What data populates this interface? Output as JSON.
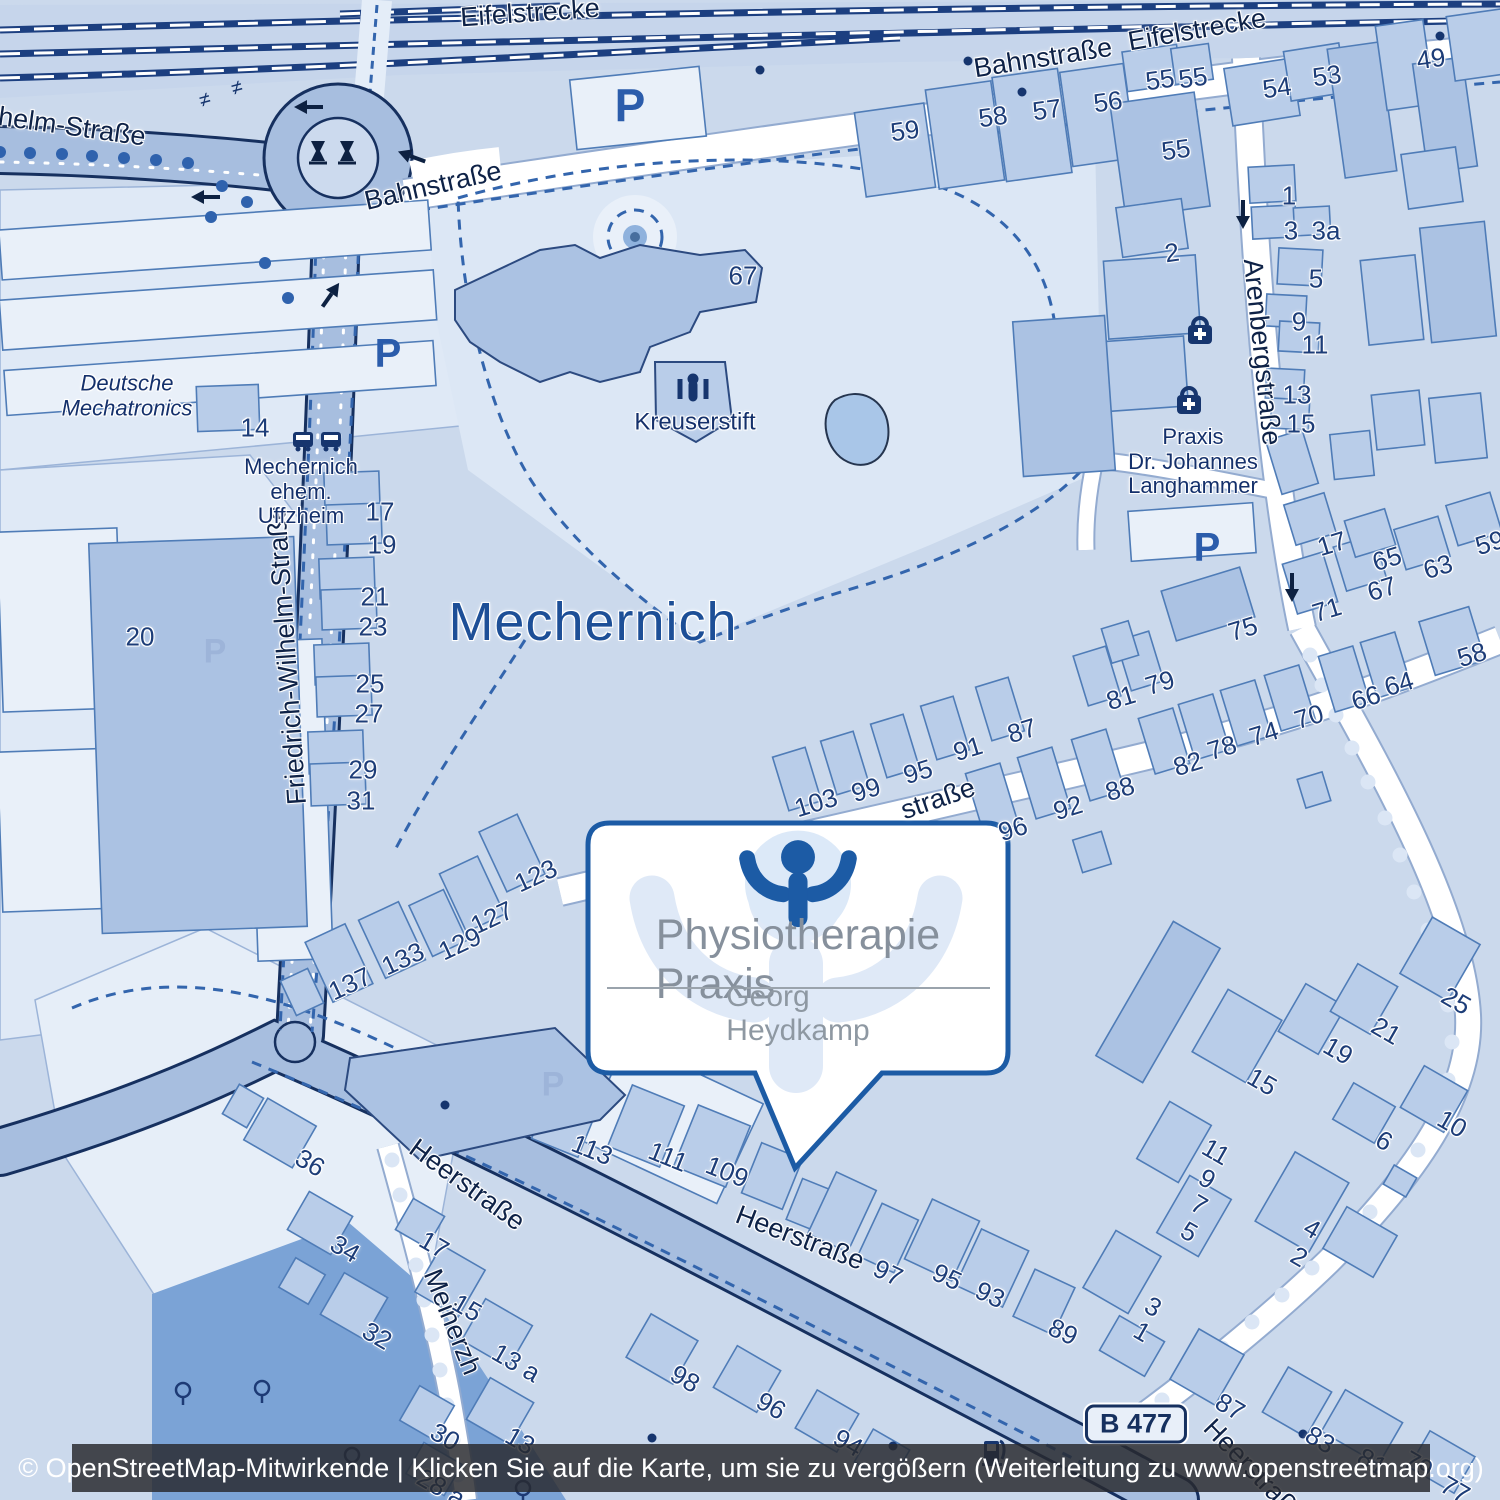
{
  "attribution": {
    "text": "© OpenStreetMap-Mitwirkende | Klicken Sie auf die Karte, um sie zu vergößern (Weiterleitung zu www.openstreetmap.org)"
  },
  "callout": {
    "title": "Physiotherapie Praxis",
    "subtitle": "Georg Heydkamp",
    "logo": "raised-arms-person-icon"
  },
  "route_badge": {
    "text": "B 477",
    "x": 1136,
    "y": 1424
  },
  "city_label": {
    "text": "Mechernich",
    "x": 593,
    "y": 622
  },
  "street_labels": [
    {
      "t": "Eifelstrecke",
      "x": 530,
      "y": 13,
      "r": -4
    },
    {
      "t": "Eifelstrecke",
      "x": 1197,
      "y": 30,
      "r": -10
    },
    {
      "t": "Bahnstraße",
      "x": 1043,
      "y": 58,
      "r": -9
    },
    {
      "t": "Bahnstraße",
      "x": 433,
      "y": 186,
      "r": -13
    },
    {
      "t": "ilhelm-Straße",
      "x": 66,
      "y": 126,
      "r": 8
    },
    {
      "t": "Friedrich-Wilhelm-Straße",
      "x": 287,
      "y": 655,
      "r": -94
    },
    {
      "t": "Arenbergstraße",
      "x": 1262,
      "y": 352,
      "r": 84
    },
    {
      "t": "Heerstraße",
      "x": 467,
      "y": 1185,
      "r": 36
    },
    {
      "t": "Heerstraße",
      "x": 800,
      "y": 1238,
      "r": 21
    },
    {
      "t": "Heerstraße",
      "x": 1255,
      "y": 1472,
      "r": 46
    },
    {
      "t": "Meinerzh",
      "x": 452,
      "y": 1322,
      "r": 68
    },
    {
      "t": "straße",
      "x": 938,
      "y": 799,
      "r": -19
    }
  ],
  "poi_labels": [
    {
      "t": "Deutsche\nMechatronics",
      "x": 127,
      "y": 396,
      "it": true
    },
    {
      "t": "Mechernich\nehem.\nUffzheim",
      "x": 301,
      "y": 492
    },
    {
      "t": "Kreuserstift",
      "x": 695,
      "y": 423,
      "s": 24
    },
    {
      "t": "Praxis\nDr. Johannes\nLanghammer",
      "x": 1193,
      "y": 462
    }
  ],
  "house_numbers": [
    {
      "t": "59",
      "x": 905,
      "y": 131,
      "r": -8
    },
    {
      "t": "58",
      "x": 993,
      "y": 117,
      "r": -8
    },
    {
      "t": "57",
      "x": 1047,
      "y": 110,
      "r": -8
    },
    {
      "t": "56",
      "x": 1108,
      "y": 102,
      "r": -8
    },
    {
      "t": "55",
      "x": 1160,
      "y": 80,
      "r": -8
    },
    {
      "t": "55",
      "x": 1193,
      "y": 78,
      "r": -8
    },
    {
      "t": "55",
      "x": 1176,
      "y": 150,
      "r": -8
    },
    {
      "t": "2",
      "x": 1172,
      "y": 253,
      "r": -8
    },
    {
      "t": "54",
      "x": 1277,
      "y": 88,
      "r": -8
    },
    {
      "t": "53",
      "x": 1327,
      "y": 76,
      "r": -8
    },
    {
      "t": "49",
      "x": 1431,
      "y": 59,
      "r": -8
    },
    {
      "t": "1",
      "x": 1289,
      "y": 196
    },
    {
      "t": "3",
      "x": 1291,
      "y": 231
    },
    {
      "t": "3a",
      "x": 1326,
      "y": 231
    },
    {
      "t": "5",
      "x": 1316,
      "y": 279
    },
    {
      "t": "9",
      "x": 1299,
      "y": 322
    },
    {
      "t": "11",
      "x": 1315,
      "y": 345
    },
    {
      "t": "13",
      "x": 1297,
      "y": 395
    },
    {
      "t": "15",
      "x": 1301,
      "y": 424
    },
    {
      "t": "67",
      "x": 743,
      "y": 276
    },
    {
      "t": "14",
      "x": 255,
      "y": 428
    },
    {
      "t": "20",
      "x": 140,
      "y": 637
    },
    {
      "t": "17",
      "x": 380,
      "y": 512
    },
    {
      "t": "19",
      "x": 382,
      "y": 545
    },
    {
      "t": "21",
      "x": 375,
      "y": 597
    },
    {
      "t": "23",
      "x": 373,
      "y": 627
    },
    {
      "t": "25",
      "x": 370,
      "y": 684
    },
    {
      "t": "27",
      "x": 369,
      "y": 714
    },
    {
      "t": "29",
      "x": 363,
      "y": 770
    },
    {
      "t": "31",
      "x": 361,
      "y": 801
    },
    {
      "t": "17",
      "x": 1332,
      "y": 544,
      "r": -17
    },
    {
      "t": "65",
      "x": 1387,
      "y": 559,
      "r": -17
    },
    {
      "t": "63",
      "x": 1438,
      "y": 567,
      "r": -17
    },
    {
      "t": "59",
      "x": 1490,
      "y": 543,
      "r": -17
    },
    {
      "t": "67",
      "x": 1382,
      "y": 589,
      "r": -17
    },
    {
      "t": "71",
      "x": 1327,
      "y": 610,
      "r": -17
    },
    {
      "t": "75",
      "x": 1243,
      "y": 629,
      "r": -17
    },
    {
      "t": "103",
      "x": 816,
      "y": 803,
      "r": -17
    },
    {
      "t": "99",
      "x": 866,
      "y": 790,
      "r": -17
    },
    {
      "t": "95",
      "x": 918,
      "y": 772,
      "r": -17
    },
    {
      "t": "91",
      "x": 968,
      "y": 749,
      "r": -17
    },
    {
      "t": "87",
      "x": 1022,
      "y": 731,
      "r": -17
    },
    {
      "t": "81",
      "x": 1121,
      "y": 698,
      "r": -17
    },
    {
      "t": "79",
      "x": 1160,
      "y": 683,
      "r": -17
    },
    {
      "t": "96",
      "x": 1013,
      "y": 829,
      "r": -17
    },
    {
      "t": "92",
      "x": 1068,
      "y": 808,
      "r": -17
    },
    {
      "t": "88",
      "x": 1120,
      "y": 789,
      "r": -17
    },
    {
      "t": "82",
      "x": 1188,
      "y": 764,
      "r": -17
    },
    {
      "t": "78",
      "x": 1222,
      "y": 748,
      "r": -17
    },
    {
      "t": "74",
      "x": 1264,
      "y": 734,
      "r": -17
    },
    {
      "t": "70",
      "x": 1309,
      "y": 717,
      "r": -17
    },
    {
      "t": "66",
      "x": 1366,
      "y": 698,
      "r": -17
    },
    {
      "t": "64",
      "x": 1399,
      "y": 684,
      "r": -17
    },
    {
      "t": "58",
      "x": 1472,
      "y": 655,
      "r": -17
    },
    {
      "t": "123",
      "x": 536,
      "y": 876,
      "r": -25
    },
    {
      "t": "127",
      "x": 492,
      "y": 918,
      "r": -25
    },
    {
      "t": "129",
      "x": 460,
      "y": 944,
      "r": -25
    },
    {
      "t": "133",
      "x": 403,
      "y": 959,
      "r": -25
    },
    {
      "t": "137",
      "x": 350,
      "y": 984,
      "r": -25
    },
    {
      "t": "113",
      "x": 592,
      "y": 1150,
      "r": 22
    },
    {
      "t": "111",
      "x": 668,
      "y": 1157,
      "r": 22
    },
    {
      "t": "109",
      "x": 727,
      "y": 1172,
      "r": 22
    },
    {
      "t": "25",
      "x": 1456,
      "y": 1001,
      "r": 30
    },
    {
      "t": "21",
      "x": 1386,
      "y": 1031,
      "r": 30
    },
    {
      "t": "19",
      "x": 1338,
      "y": 1051,
      "r": 30
    },
    {
      "t": "15",
      "x": 1262,
      "y": 1082,
      "r": 30
    },
    {
      "t": "11",
      "x": 1216,
      "y": 1152,
      "r": 30
    },
    {
      "t": "9",
      "x": 1207,
      "y": 1179,
      "r": 30
    },
    {
      "t": "7",
      "x": 1199,
      "y": 1205,
      "r": 30
    },
    {
      "t": "5",
      "x": 1189,
      "y": 1232,
      "r": 30
    },
    {
      "t": "6",
      "x": 1384,
      "y": 1141,
      "r": 30
    },
    {
      "t": "10",
      "x": 1452,
      "y": 1124,
      "r": 30
    },
    {
      "t": "4",
      "x": 1312,
      "y": 1229,
      "r": 30
    },
    {
      "t": "2",
      "x": 1299,
      "y": 1257,
      "r": 30
    },
    {
      "t": "97",
      "x": 888,
      "y": 1273,
      "r": 25
    },
    {
      "t": "95",
      "x": 947,
      "y": 1277,
      "r": 25
    },
    {
      "t": "93",
      "x": 990,
      "y": 1295,
      "r": 25
    },
    {
      "t": "89",
      "x": 1063,
      "y": 1332,
      "r": 25
    },
    {
      "t": "3",
      "x": 1153,
      "y": 1307,
      "r": 30
    },
    {
      "t": "1",
      "x": 1142,
      "y": 1332,
      "r": 30
    },
    {
      "t": "87",
      "x": 1230,
      "y": 1407,
      "r": 30
    },
    {
      "t": "83",
      "x": 1320,
      "y": 1440,
      "r": 30
    },
    {
      "t": "81",
      "x": 1372,
      "y": 1462,
      "r": 30
    },
    {
      "t": "79",
      "x": 1418,
      "y": 1465,
      "r": 30
    },
    {
      "t": "77",
      "x": 1455,
      "y": 1490,
      "r": 30
    },
    {
      "t": "36",
      "x": 310,
      "y": 1163,
      "r": 30
    },
    {
      "t": "34",
      "x": 345,
      "y": 1249,
      "r": 30
    },
    {
      "t": "17",
      "x": 434,
      "y": 1245,
      "r": 30
    },
    {
      "t": "15",
      "x": 467,
      "y": 1308,
      "r": 30
    },
    {
      "t": "32",
      "x": 377,
      "y": 1336,
      "r": 30
    },
    {
      "t": "13 a",
      "x": 516,
      "y": 1363,
      "r": 30
    },
    {
      "t": "13",
      "x": 520,
      "y": 1441,
      "r": 30
    },
    {
      "t": "30",
      "x": 445,
      "y": 1437,
      "r": 30
    },
    {
      "t": "28 a",
      "x": 441,
      "y": 1488,
      "r": 30
    },
    {
      "t": "98",
      "x": 685,
      "y": 1379,
      "r": 30
    },
    {
      "t": "96",
      "x": 771,
      "y": 1406,
      "r": 30
    },
    {
      "t": "94",
      "x": 848,
      "y": 1443,
      "r": 30
    }
  ],
  "icons": [
    {
      "type": "parking-icon",
      "x": 630,
      "y": 105,
      "s": 46
    },
    {
      "type": "parking-icon",
      "x": 388,
      "y": 352,
      "s": 40
    },
    {
      "type": "parking-icon",
      "x": 1207,
      "y": 546,
      "s": 40
    },
    {
      "type": "parking-icon",
      "x": 215,
      "y": 650,
      "s": 34,
      "faint": true
    },
    {
      "type": "parking-icon",
      "x": 553,
      "y": 1083,
      "s": 34,
      "faint": true
    },
    {
      "type": "bus-stop-icon",
      "x": 303,
      "y": 441
    },
    {
      "type": "bus-stop-icon",
      "x": 331,
      "y": 441
    },
    {
      "type": "pharmacy-icon",
      "x": 1200,
      "y": 332
    },
    {
      "type": "pharmacy-icon",
      "x": 1189,
      "y": 402
    },
    {
      "type": "social-facility-icon",
      "x": 693,
      "y": 387
    },
    {
      "type": "fuel-station-icon",
      "x": 993,
      "y": 1452
    },
    {
      "type": "monument-icon",
      "x": 318,
      "y": 152
    },
    {
      "type": "monument-icon",
      "x": 347,
      "y": 152
    },
    {
      "type": "tree-icon",
      "x": 183,
      "y": 1394
    },
    {
      "type": "tree-icon",
      "x": 262,
      "y": 1392
    },
    {
      "type": "tree-icon",
      "x": 352,
      "y": 1459
    },
    {
      "type": "tree-icon",
      "x": 523,
      "y": 1492
    },
    {
      "type": "street-tree-dot",
      "x": 0,
      "y": 152
    },
    {
      "type": "street-tree-dot",
      "x": 30,
      "y": 153
    },
    {
      "type": "street-tree-dot",
      "x": 62,
      "y": 154
    },
    {
      "type": "street-tree-dot",
      "x": 92,
      "y": 156
    },
    {
      "type": "street-tree-dot",
      "x": 124,
      "y": 158
    },
    {
      "type": "street-tree-dot",
      "x": 156,
      "y": 160
    },
    {
      "type": "street-tree-dot",
      "x": 188,
      "y": 163
    },
    {
      "type": "street-tree-dot",
      "x": 222,
      "y": 186
    },
    {
      "type": "street-tree-dot",
      "x": 247,
      "y": 202
    },
    {
      "type": "street-tree-dot",
      "x": 211,
      "y": 217
    },
    {
      "type": "street-tree-dot",
      "x": 265,
      "y": 263
    },
    {
      "type": "street-tree-dot",
      "x": 288,
      "y": 298
    },
    {
      "type": "entrance-dot",
      "x": 760,
      "y": 70
    },
    {
      "type": "entrance-dot",
      "x": 968,
      "y": 61
    },
    {
      "type": "entrance-dot",
      "x": 1022,
      "y": 92
    },
    {
      "type": "entrance-dot",
      "x": 1440,
      "y": 36
    },
    {
      "type": "entrance-dot",
      "x": 893,
      "y": 1446
    },
    {
      "type": "entrance-dot",
      "x": 1303,
      "y": 1434
    },
    {
      "type": "entrance-dot",
      "x": 445,
      "y": 1105
    },
    {
      "type": "entrance-dot",
      "x": 652,
      "y": 1438
    },
    {
      "type": "oneway-arrow-icon",
      "x": 310,
      "y": 107,
      "r": 180
    },
    {
      "type": "oneway-arrow-icon",
      "x": 413,
      "y": 157,
      "r": 200
    },
    {
      "type": "oneway-arrow-icon",
      "x": 207,
      "y": 197,
      "r": 180
    },
    {
      "type": "oneway-arrow-icon",
      "x": 330,
      "y": 296,
      "r": -55
    },
    {
      "type": "oneway-arrow-icon",
      "x": 1243,
      "y": 213,
      "r": 90
    },
    {
      "type": "oneway-arrow-icon",
      "x": 1292,
      "y": 586,
      "r": 90
    },
    {
      "type": "power-line-icon",
      "x": 205,
      "y": 100
    },
    {
      "type": "power-line-icon",
      "x": 237,
      "y": 88
    }
  ],
  "colors": {
    "land": "#cbd9ec",
    "building": "#b9cde9",
    "building_dark": "#abc2e3",
    "zone_light": "#dfe9f6",
    "road_fill": "#a7bedf",
    "road_casing": "#16305f",
    "rail": "#1c3f80",
    "park_dark": "#7ba3d6",
    "accent_logo": "#1c5ba5",
    "label_navy": "#1d3d78",
    "gray_text": "#86909c",
    "pond": "#a9c6e8"
  }
}
